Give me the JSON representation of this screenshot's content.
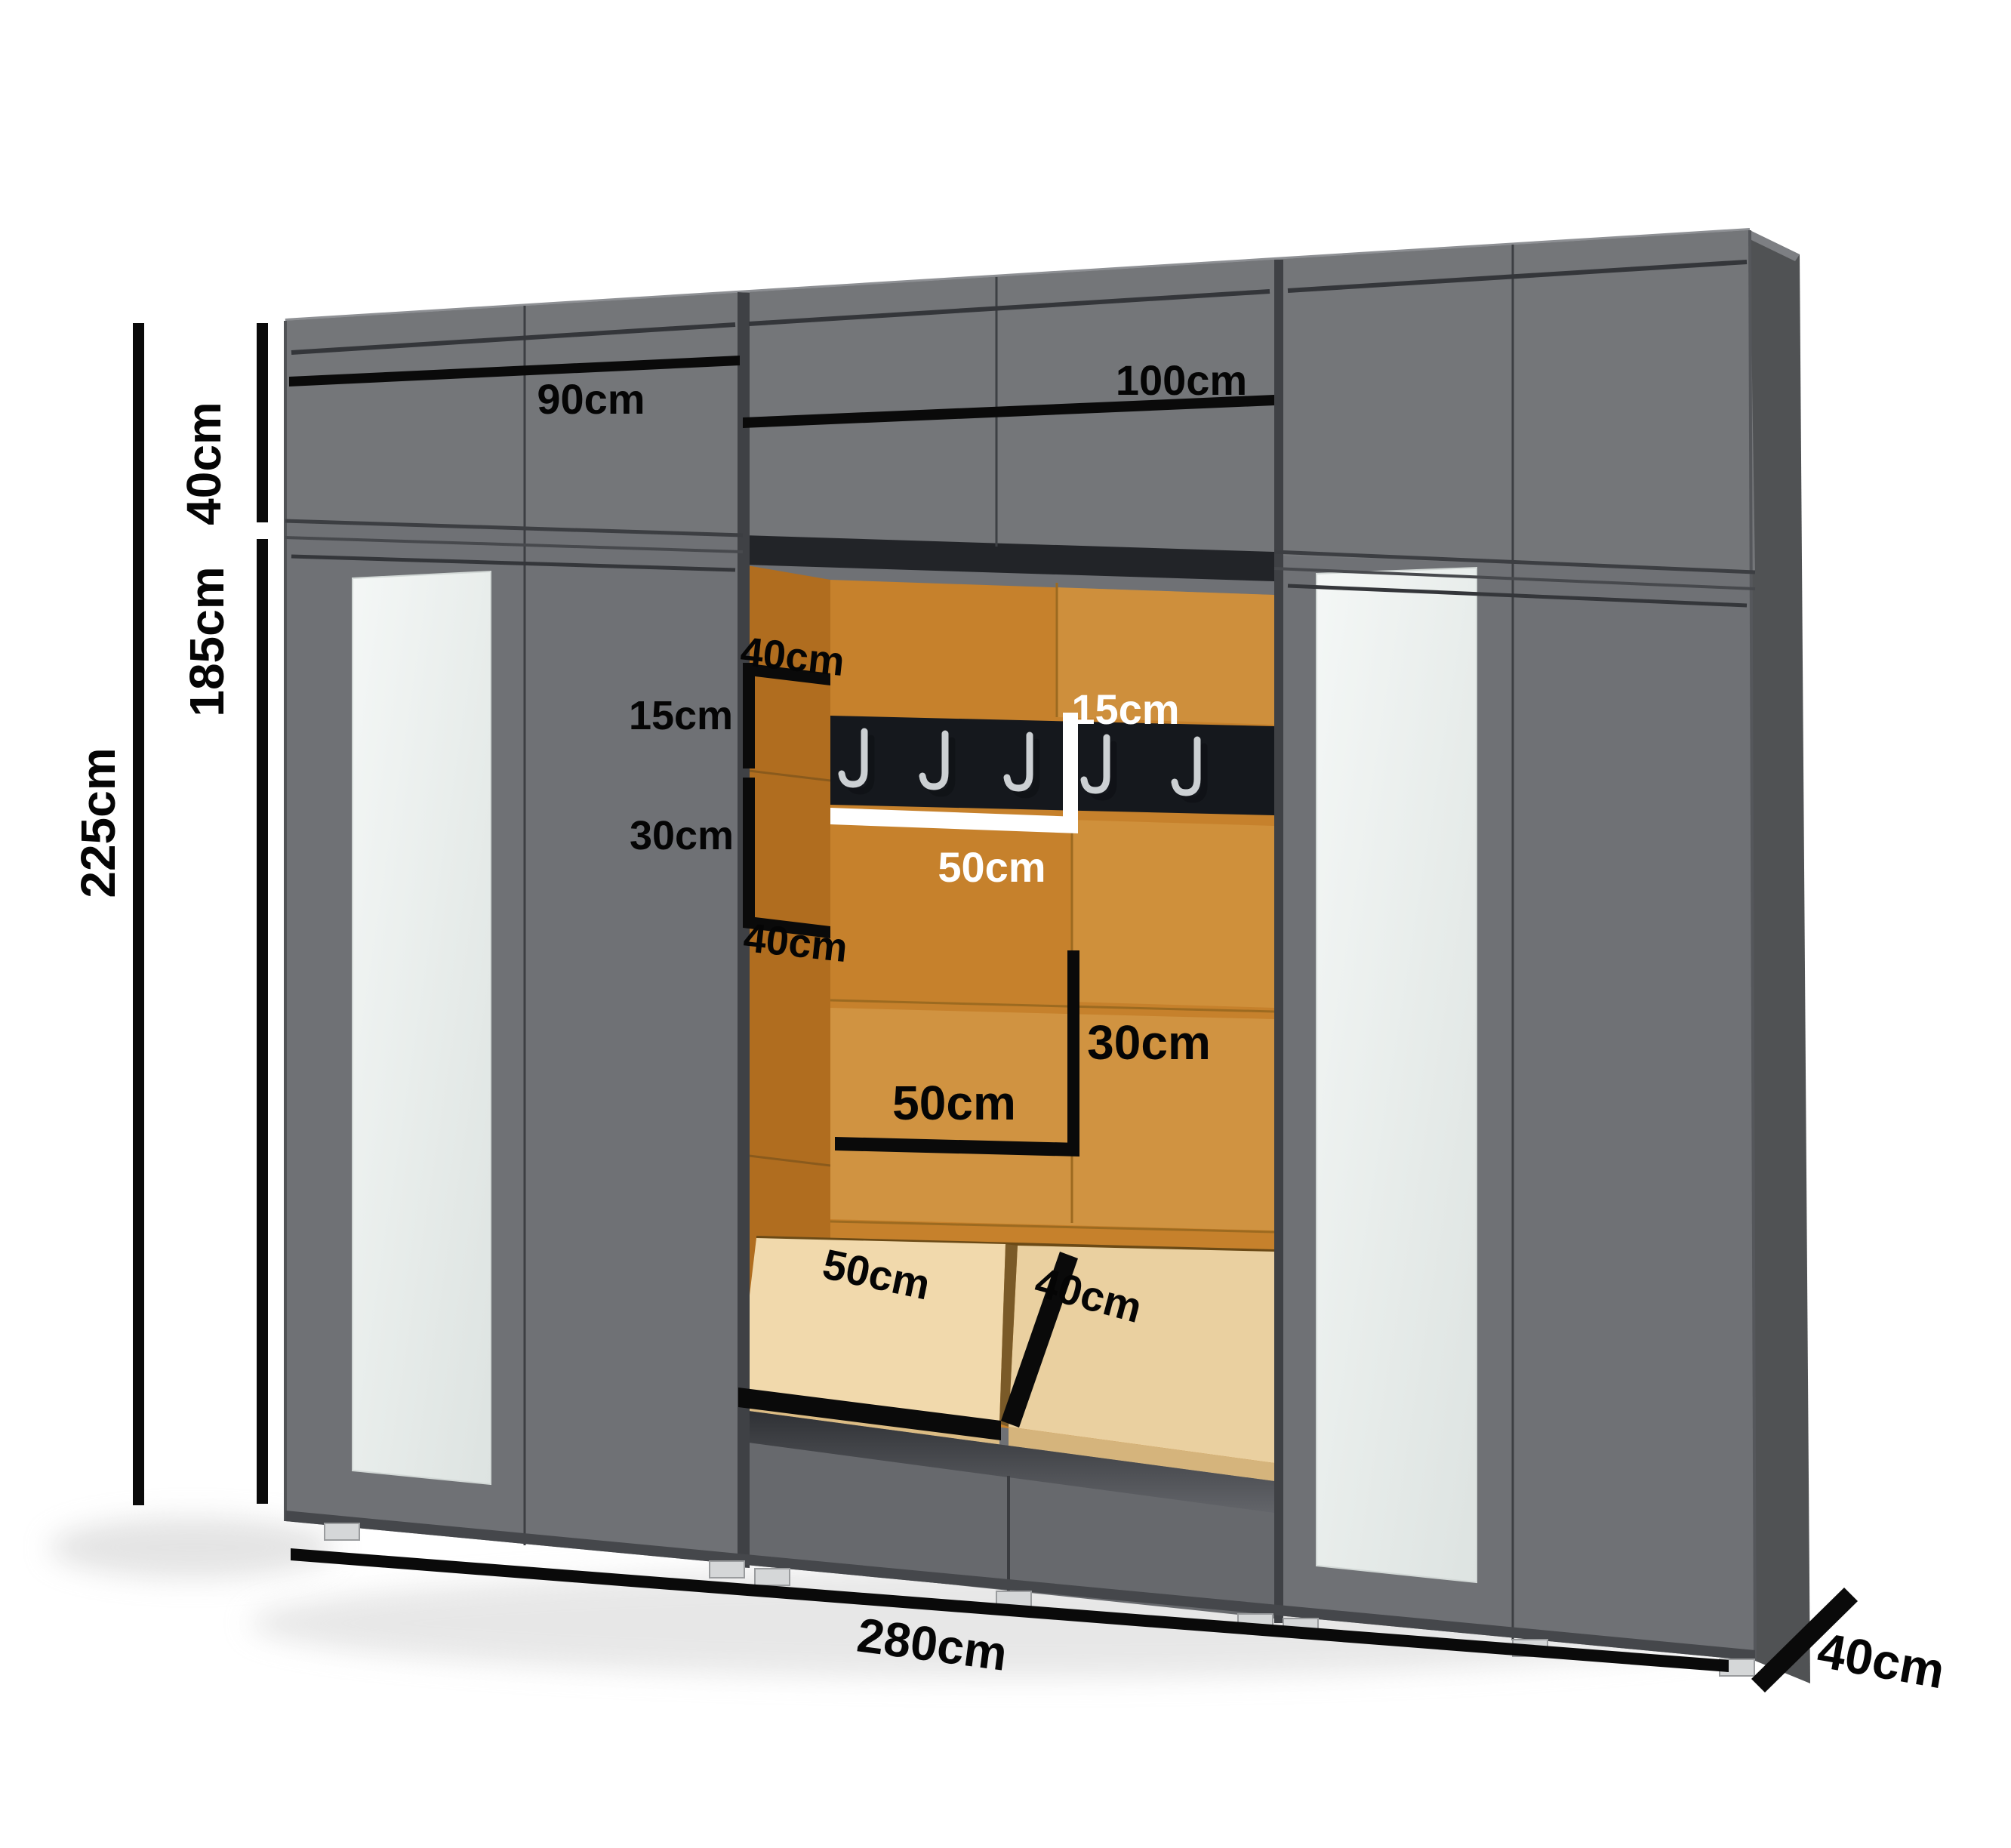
{
  "diagram": {
    "title": "Hallway wardrobe wall unit dimension diagram",
    "unit": "cm"
  },
  "dims": {
    "height_total": "225cm",
    "height_top": "40cm",
    "height_lower": "185cm",
    "width_left": "90cm",
    "width_center": "100cm",
    "width_total": "280cm",
    "depth": "40cm"
  },
  "niche": {
    "side_top_width": "40cm",
    "side_upper_height": "15cm",
    "side_mid_height": "30cm",
    "side_bottom_width": "40cm",
    "rail_height": "15cm",
    "rail_width": "50cm",
    "panel_width": "50cm",
    "panel_height": "30cm",
    "seat_width": "50cm",
    "seat_depth": "40cm",
    "hook_count": 5
  },
  "colors": {
    "cabinet_front": "#6f7175",
    "cabinet_top_row": "#747679",
    "side_panel": "#505254",
    "seam": "#3d3f43",
    "niche_orange": "#c6812c",
    "niche_side_orange": "#b06d1f",
    "rail_black": "#15181d",
    "hook_silver": "#ccd0d3",
    "seat_cream": "#f1d9ac",
    "mirror": "#e9edec",
    "dimension_black": "#0a0a0a",
    "dimension_white": "#ffffff",
    "background": "#ffffff"
  }
}
